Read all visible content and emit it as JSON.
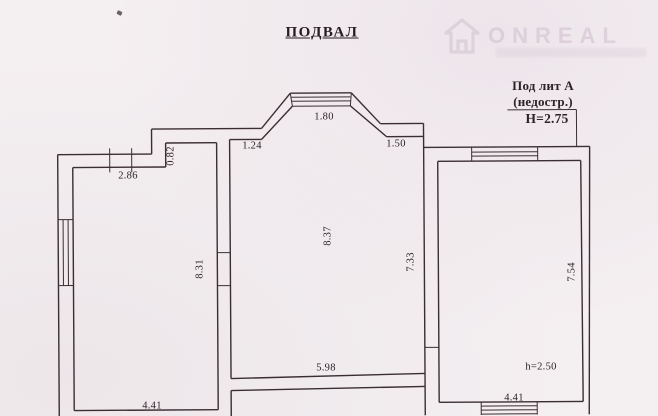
{
  "title": "ПОДВАЛ",
  "annotation": {
    "line1": "Под лит А",
    "line2": "(недостр.)",
    "height": "Н=2.75"
  },
  "watermark": {
    "text": "ONREAL",
    "icon": "house-icon"
  },
  "dimensions": {
    "bay_window_width": "1.80",
    "bay_left_wall_length": "1.24",
    "bay_right_wall_length": "1.50",
    "wall_step_depth": "0.82",
    "left_room_top_width": "2.86",
    "left_room_depth": "8.31",
    "central_room_depth": "8.37",
    "central_room_right_depth": "7.33",
    "right_room_depth": "7.54",
    "central_room_bottom_width": "5.98",
    "left_room_bottom_width": "4.41",
    "right_room_ceiling_height": "h=2.50",
    "right_room_bottom_width": "4.41"
  },
  "colors": {
    "paper": "#f4eff1",
    "line": "#3a2e33",
    "ink": "#2a2127",
    "watermark": "#c4b0c2"
  }
}
